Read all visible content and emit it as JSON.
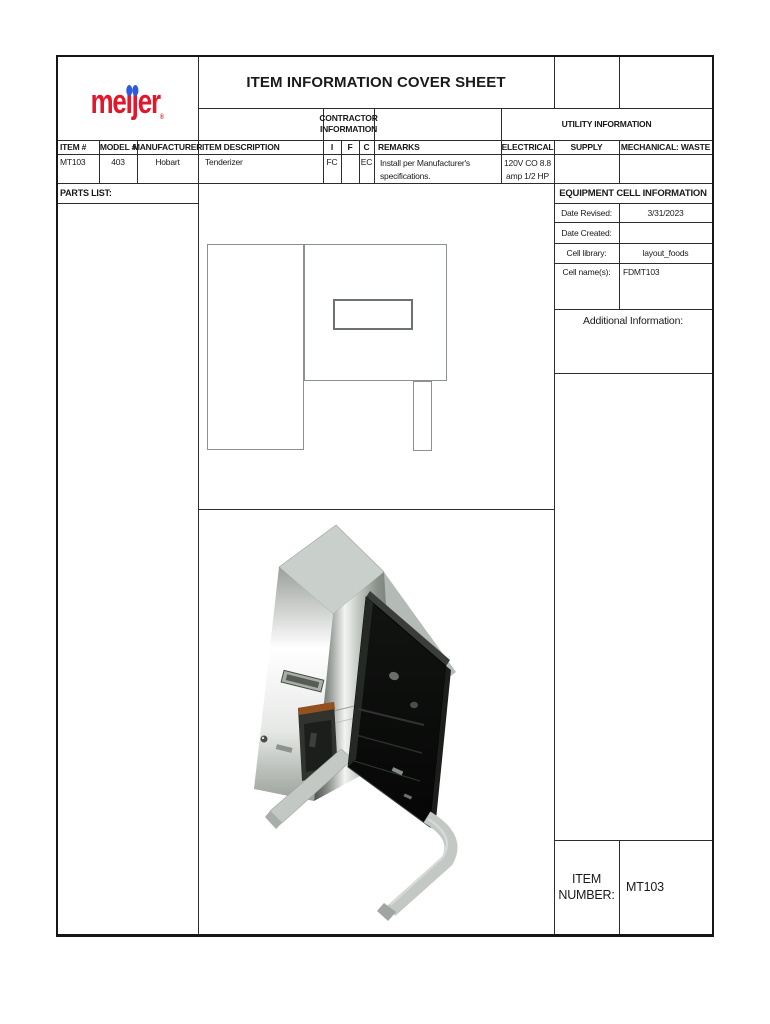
{
  "brand": {
    "logo_pre": "me",
    "logo_i": "i",
    "logo_j": "j",
    "logo_post": "er",
    "registered": "®",
    "logo_red": "#e2172c",
    "logo_blue": "#2b5be0"
  },
  "header": {
    "title": "ITEM INFORMATION COVER SHEET",
    "contractor_line1": "CONTRACTOR",
    "contractor_line2": "INFORMATION",
    "utility": "UTILITY INFORMATION"
  },
  "table": {
    "headers": {
      "item": "ITEM #",
      "model": "MODEL #",
      "manufacturer": "MANUFACTURER",
      "description": "ITEM DESCRIPTION",
      "i": "I",
      "f": "F",
      "c": "C",
      "remarks": "REMARKS",
      "electrical": "ELECTRICAL",
      "supply": "SUPPLY",
      "mechanical": "MECHANICAL: WASTE"
    },
    "row": {
      "item": "MT103",
      "model": "403",
      "manufacturer": "Hobart",
      "description": "Tenderizer",
      "i": "FC",
      "f": "",
      "c": "EC",
      "remarks_line1": "Install per Manufacturer's",
      "remarks_line2": "specifications.",
      "electrical_line1": "120V CO 8.8",
      "electrical_line2": "amp 1/2 HP",
      "supply": "",
      "mechanical": ""
    }
  },
  "parts_list_label": "PARTS LIST:",
  "equipment_cell": {
    "title": "EQUIPMENT CELL INFORMATION",
    "rows": [
      {
        "label": "Date Revised:",
        "value": "3/31/2023"
      },
      {
        "label": "Date Created:",
        "value": ""
      },
      {
        "label": "Cell library:",
        "value": "layout_foods"
      },
      {
        "label": "Cell name(s):",
        "value": "FDMT103"
      }
    ],
    "additional_info_label": "Additional Information:"
  },
  "item_number": {
    "label_line1": "ITEM",
    "label_line2": "NUMBER:",
    "value": "MT103"
  }
}
